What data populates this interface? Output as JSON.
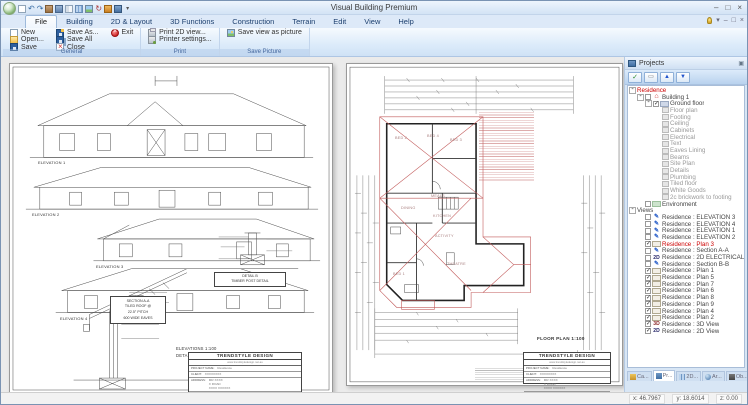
{
  "window": {
    "title": "Visual Building Premium"
  },
  "icons": {
    "minimize": "–",
    "maximize": "□",
    "close": "×",
    "dropdown": "▾",
    "pin": "▣",
    "check": "✓",
    "box": "▭",
    "up": "▲",
    "down": "▼"
  },
  "ribbon": {
    "tabs": [
      {
        "label": "File",
        "active": true
      },
      {
        "label": "Building"
      },
      {
        "label": "2D & Layout"
      },
      {
        "label": "3D Functions"
      },
      {
        "label": "Construction"
      },
      {
        "label": "Terrain"
      },
      {
        "label": "Edit"
      },
      {
        "label": "View"
      },
      {
        "label": "Help"
      }
    ],
    "groups": [
      {
        "label": "General",
        "buttons": [
          {
            "label": "New"
          },
          {
            "label": "Open..."
          },
          {
            "label": "Save"
          },
          {
            "label": "Save As..."
          },
          {
            "label": "Save All"
          },
          {
            "label": "Close"
          },
          {
            "label": "Exit"
          }
        ]
      },
      {
        "label": "Print",
        "buttons": [
          {
            "label": "Print 2D view..."
          },
          {
            "label": "Printer settings..."
          }
        ]
      },
      {
        "label": "Save Picture",
        "buttons": [
          {
            "label": "Save view as picture"
          }
        ]
      }
    ]
  },
  "left_doc": {
    "elevation_labels": [
      "ELEVATION 1",
      "ELEVATION 2",
      "ELEVATION 3",
      "ELEVATION 4"
    ],
    "section_box": [
      "SECTION A-A",
      "TILED ROOF @",
      "22.5° PITCH",
      "600 WIDE EAVES"
    ],
    "detail_box": [
      "DETAIL B",
      "TIMBER POST DETAIL"
    ],
    "scale_notes": [
      "ELEVATIONS 1:100",
      "DETAILS 1:20"
    ]
  },
  "right_doc": {
    "rooms": [
      "BED 2",
      "BED 4",
      "BED 3",
      "MEALS",
      "DINING",
      "KITCHEN",
      "ACTIVITY",
      "THEATRE",
      "BED 1"
    ],
    "plan_label": "FLOOR PLAN 1:100"
  },
  "title_block": {
    "company": "TRENDSTYLE DESIGN",
    "website": "www.trendstyledesign.net.au",
    "project_label": "PROJECT NAME:",
    "project": "Residence",
    "client_label": "CLIENT:",
    "client": "XXXXXXXX",
    "address_label": "ADDRESS:",
    "address1": "MR XXXX",
    "address2": "X ROAD",
    "address3": "XXXX XXXXXX"
  },
  "projects": {
    "title": "Projects",
    "tree": [
      {
        "t": "Residence",
        "i": 0,
        "e": 1,
        "red": 1
      },
      {
        "t": "Building 1",
        "i": 1,
        "e": 1,
        "c": "off",
        "k": "building"
      },
      {
        "t": "Ground floor",
        "i": 2,
        "e": 1,
        "c": "on",
        "k": "floor"
      },
      {
        "t": "Floor plan",
        "i": 3,
        "k": "layer",
        "dim": 1
      },
      {
        "t": "Footing",
        "i": 3,
        "k": "layer",
        "dim": 1
      },
      {
        "t": "Ceiling",
        "i": 3,
        "k": "layer",
        "dim": 1
      },
      {
        "t": "Cabinets",
        "i": 3,
        "k": "layer",
        "dim": 1
      },
      {
        "t": "Electrical",
        "i": 3,
        "k": "layer",
        "dim": 1
      },
      {
        "t": "Text",
        "i": 3,
        "k": "layer",
        "dim": 1
      },
      {
        "t": "Eaves Lining",
        "i": 3,
        "k": "layer",
        "dim": 1
      },
      {
        "t": "Beams",
        "i": 3,
        "k": "layer",
        "dim": 1
      },
      {
        "t": "Site Plan",
        "i": 3,
        "k": "layer",
        "dim": 1
      },
      {
        "t": "Details",
        "i": 3,
        "k": "layer",
        "dim": 1
      },
      {
        "t": "Plumbing",
        "i": 3,
        "k": "layer",
        "dim": 1
      },
      {
        "t": "Tiled floor",
        "i": 3,
        "k": "layer",
        "dim": 1
      },
      {
        "t": "White Goods",
        "i": 3,
        "k": "layer",
        "dim": 1
      },
      {
        "t": "2c brickwork to footing",
        "i": 3,
        "k": "layer",
        "dim": 1
      },
      {
        "t": "Environment",
        "i": 1,
        "c": "off",
        "k": "env"
      },
      {
        "t": "Views",
        "i": 0,
        "e": 1
      },
      {
        "t": "Residence : ELEVATION 3",
        "i": 1,
        "c": "off",
        "k": "pencil"
      },
      {
        "t": "Residence : ELEVATION 4",
        "i": 1,
        "c": "off",
        "k": "pencil"
      },
      {
        "t": "Residence : ELEVATION 1",
        "i": 1,
        "c": "off",
        "k": "pencil"
      },
      {
        "t": "Residence : ELEVATION 2",
        "i": 1,
        "c": "off",
        "k": "pencil"
      },
      {
        "t": "Residence : Plan 3",
        "i": 1,
        "c": "on",
        "k": "plan",
        "red": 1
      },
      {
        "t": "Residence : Section A-A",
        "i": 1,
        "c": "off",
        "k": "pencil"
      },
      {
        "t": "Residence : 2D ELECTRICAL",
        "i": 1,
        "c": "off",
        "k": "2d"
      },
      {
        "t": "Residence : Section B-B",
        "i": 1,
        "c": "off",
        "k": "pencil"
      },
      {
        "t": "Residence : Plan 1",
        "i": 1,
        "c": "on",
        "k": "plan"
      },
      {
        "t": "Residence : Plan 5",
        "i": 1,
        "c": "on",
        "k": "plan"
      },
      {
        "t": "Residence : Plan 7",
        "i": 1,
        "c": "on",
        "k": "plan"
      },
      {
        "t": "Residence : Plan 6",
        "i": 1,
        "c": "on",
        "k": "plan"
      },
      {
        "t": "Residence : Plan 8",
        "i": 1,
        "c": "on",
        "k": "plan"
      },
      {
        "t": "Residence : Plan 9",
        "i": 1,
        "c": "on",
        "k": "plan"
      },
      {
        "t": "Residence : Plan 4",
        "i": 1,
        "c": "on",
        "k": "plan"
      },
      {
        "t": "Residence : Plan 2",
        "i": 1,
        "c": "on",
        "k": "plan"
      },
      {
        "t": "Residence : 3D View",
        "i": 1,
        "c": "on",
        "k": "3d"
      },
      {
        "t": "Residence : 2D View",
        "i": 1,
        "c": "on",
        "k": "2d"
      }
    ],
    "tabs": [
      {
        "label": "Ca...",
        "k": "catalog"
      },
      {
        "label": "Pr...",
        "k": "projects",
        "active": true
      },
      {
        "label": "2D...",
        "k": "2d"
      },
      {
        "label": "Ar...",
        "k": "area"
      },
      {
        "label": "Ob...",
        "k": "objects"
      },
      {
        "label": "PV...",
        "k": "pv"
      }
    ],
    "coords": [
      "x: 46.7967",
      "y: 18.6014",
      "z: 0.00"
    ]
  }
}
